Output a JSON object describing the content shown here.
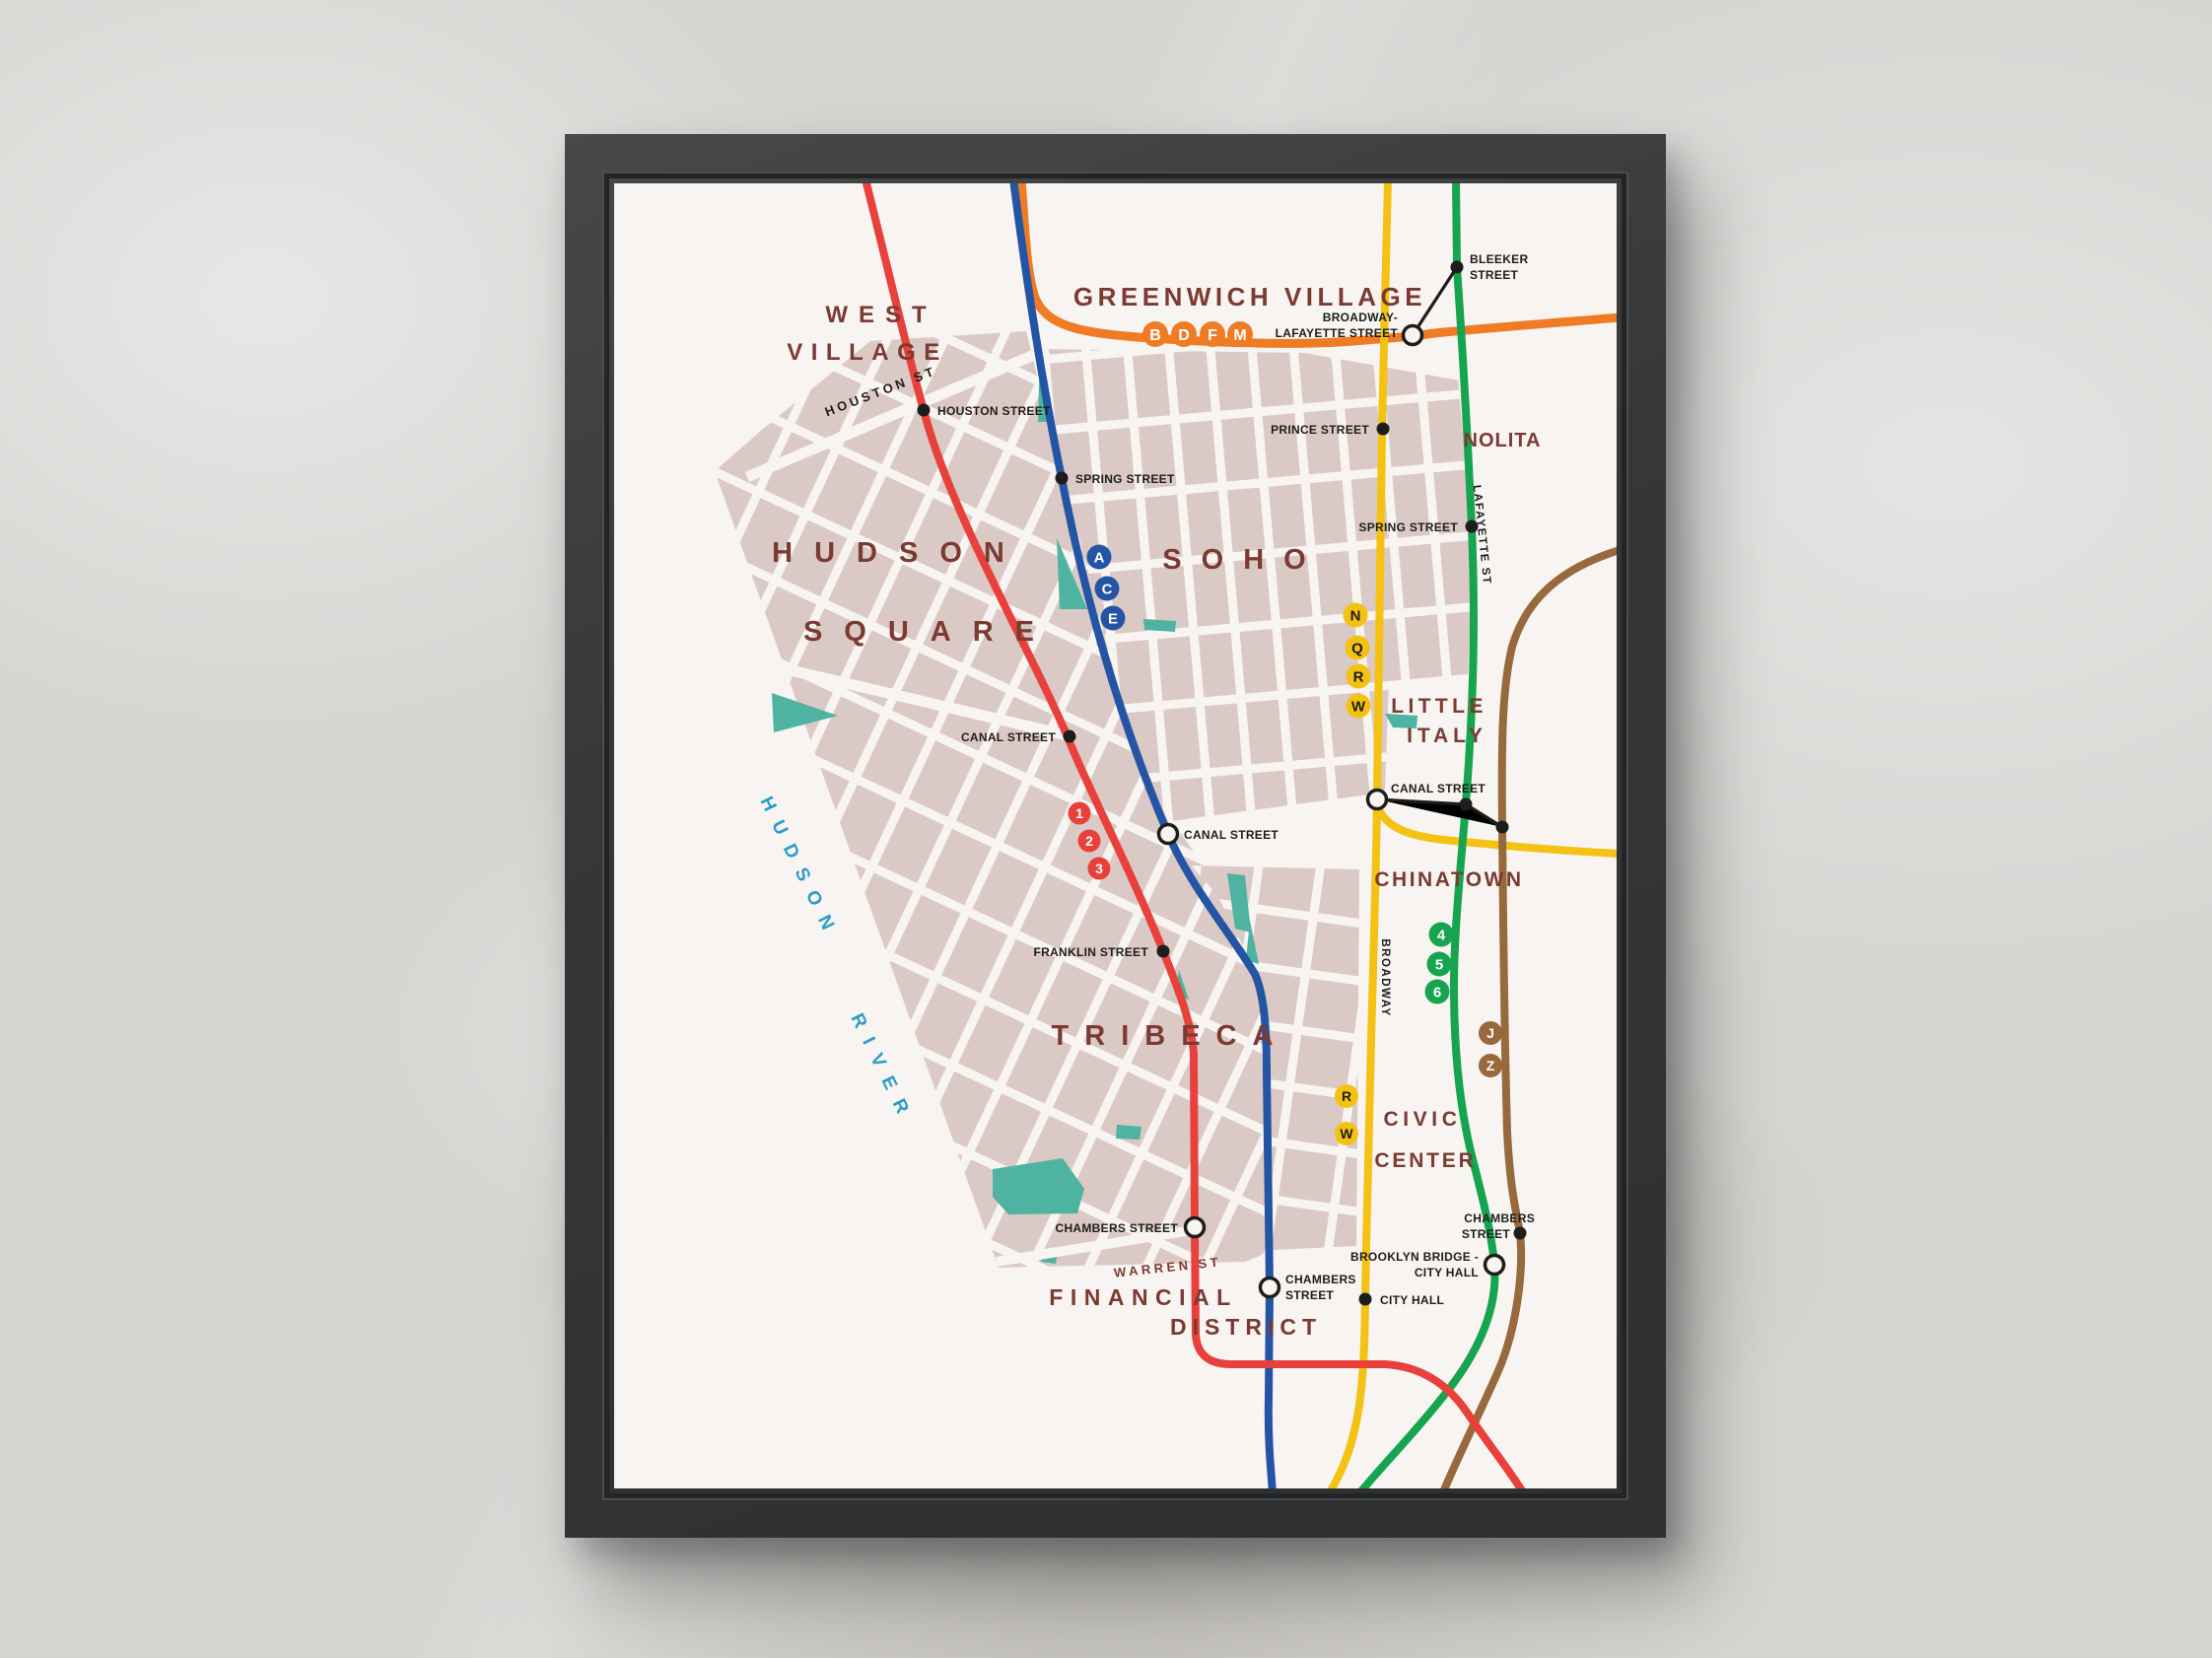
{
  "map": {
    "neighborhoods": {
      "west_village": [
        "WEST",
        "VILLAGE"
      ],
      "greenwich_village": "GREENWICH VILLAGE",
      "nolita": "NOLITA",
      "hudson_square": [
        "HUDSON",
        "SQUARE"
      ],
      "soho": "SOHO",
      "little_italy": [
        "LITTLE",
        "ITALY"
      ],
      "chinatown": "CHINATOWN",
      "tribeca": "TRIBECA",
      "civic_center": [
        "CIVIC",
        "CENTER"
      ],
      "financial_district": [
        "FINANCIAL",
        "DISTRICT"
      ]
    },
    "water": [
      "HUDSON",
      "RIVER"
    ],
    "streets": {
      "houston": "HOUSTON ST",
      "lafayette": "LAFAYETTE ST",
      "broadway": "BROADWAY",
      "warren": "WARREN ST"
    },
    "stations": {
      "bleeker": [
        "BLEEKER",
        "STREET"
      ],
      "broadway_lafayette": [
        "BROADWAY-",
        "LAFAYETTE STREET"
      ],
      "houston": "HOUSTON STREET",
      "spring_ace": "SPRING STREET",
      "prince": "PRINCE STREET",
      "spring_6": "SPRING STREET",
      "canal_123": "CANAL STREET",
      "canal_ace": "CANAL STREET",
      "canal_nqrw": "CANAL STREET",
      "franklin": "FRANKLIN STREET",
      "chambers_123": "CHAMBERS STREET",
      "chambers_jz": [
        "CHAMBERS",
        "STREET"
      ],
      "brooklyn_bridge": [
        "BROOKLYN BRIDGE -",
        "CITY HALL"
      ],
      "chambers_ace": [
        "CHAMBERS",
        "STREET"
      ],
      "city_hall": "CITY HALL"
    },
    "badges": {
      "bdfm": [
        "B",
        "D",
        "F",
        "M"
      ],
      "ace": [
        "A",
        "C",
        "E"
      ],
      "nqrw": [
        "N",
        "Q",
        "R",
        "W"
      ],
      "line123": [
        "1",
        "2",
        "3"
      ],
      "line456": [
        "4",
        "5",
        "6"
      ],
      "jz": [
        "J",
        "Z"
      ],
      "rw": [
        "R",
        "W"
      ]
    },
    "colors": {
      "line_red": "#e8413b",
      "line_blue": "#2455a4",
      "line_orange": "#ef7b25",
      "line_yellow": "#f3c212",
      "line_green": "#17a44f",
      "line_brown": "#97693c",
      "city_blocks": "#dbc9c5",
      "parks": "#4eb3a1",
      "paper": "#f7f4f2",
      "neighborhood_text": "#7b3a32",
      "water_text": "#2b9cc9",
      "station_text": "#1d1d1b",
      "frame": "#37393a",
      "wall": "#d6d4d1"
    }
  }
}
